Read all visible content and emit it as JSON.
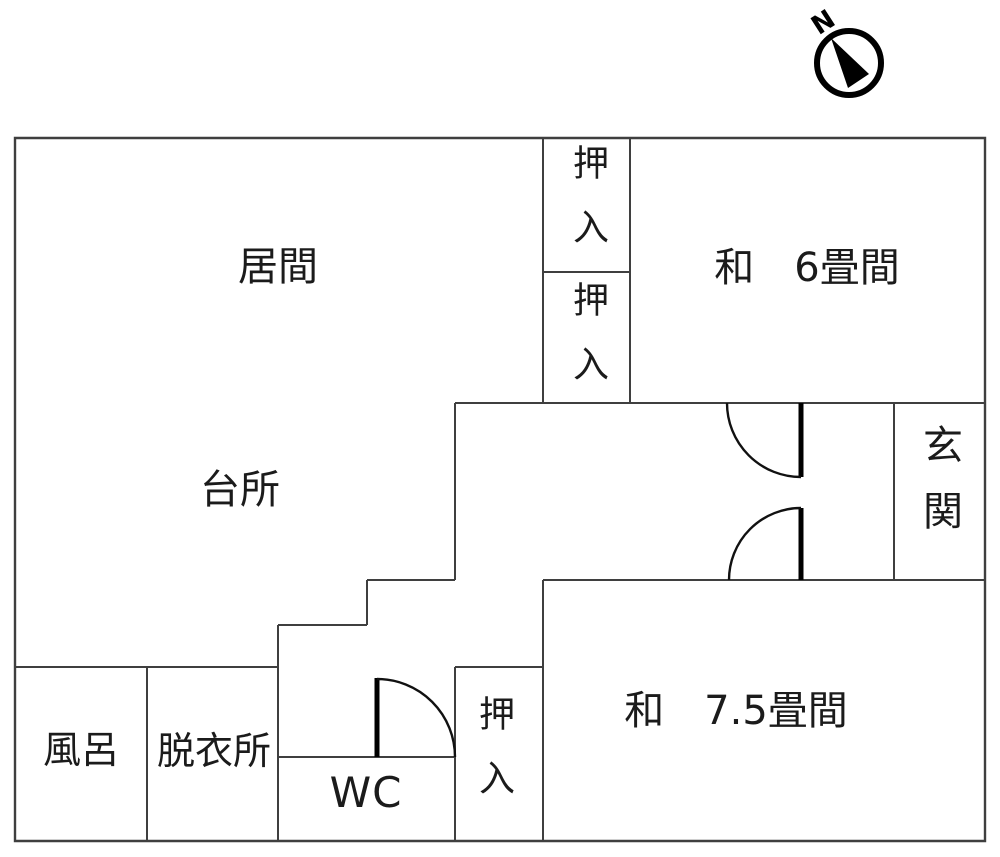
{
  "compass": {
    "north_label": "N"
  },
  "rooms": {
    "living_room": {
      "label": "居間"
    },
    "kitchen": {
      "label": "台所"
    },
    "closet_top_upper": {
      "label": "押入"
    },
    "closet_top_lower": {
      "label": "押入"
    },
    "japanese_room_6": {
      "label": "和　6畳間"
    },
    "entrance": {
      "label": "玄関"
    },
    "japanese_room_7_5": {
      "label": "和　7.5畳間"
    },
    "bath": {
      "label": "風呂"
    },
    "dressing_room": {
      "label": "脱衣所"
    },
    "toilet": {
      "label": "WC"
    },
    "closet_bottom": {
      "label": "押入"
    }
  },
  "colors": {
    "wall": "#3f3f3f",
    "door": "#000000",
    "text": "#1b1b1b",
    "background": "#ffffff"
  }
}
